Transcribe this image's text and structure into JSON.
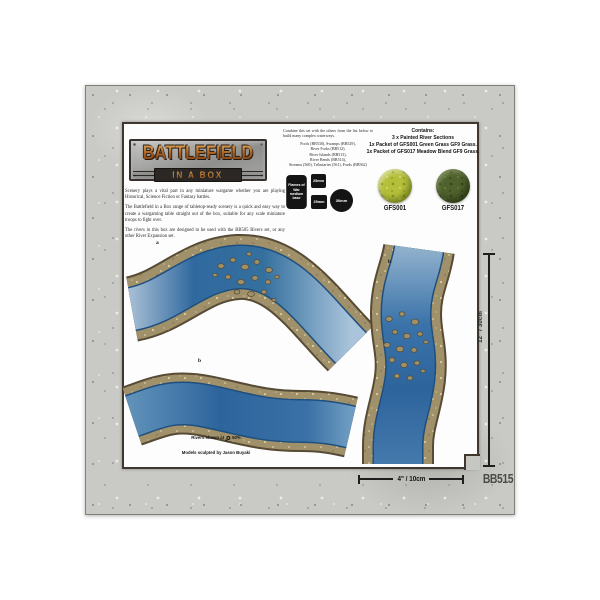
{
  "package": {
    "sku": "BB515",
    "logo": {
      "title": "BATTLEFIELD",
      "subtitle": "IN A BOX"
    },
    "intro_paragraphs": {
      "p1": "Scenery plays a vital part in any miniature wargame whether you are playing Historical, Science Fiction or Fantasy battles.",
      "p2": "The Battlefield in a Box range of tabletop-ready scenery is a quick and easy way to create a wargaming table straight out of the box, suitable for any scale miniature troops to fight over.",
      "p3": "The rivers in this box are designed to be used with the BB505 Rivers set, or any other River Expansion set."
    },
    "combine": {
      "intro": "Combine this set with the others from the list below to build many complex waterways.",
      "list": [
        "Pools (BB530), Swamps (BB529),",
        "River Forks (BB512),",
        "River Islands (BB513),",
        "River Bends (BB514),",
        "Streams (560), Tributaries (561), Fords (BB562)"
      ]
    },
    "contains": {
      "title": "Contains:",
      "lines": [
        "3 x Painted River Sections",
        "1x Packet of GFS001 Green Grass GF9 Grass.",
        "1x Packet of GFS017 Meadow Blend GF9 Grass."
      ]
    },
    "swatches": [
      {
        "code": "GFS001",
        "color": "#b4bf3a"
      },
      {
        "code": "GFS017",
        "color": "#4f612c"
      }
    ],
    "base_sizes": {
      "flames_label": "Flames of War medium base",
      "square_top": "25mm",
      "square_bottom": "25mm",
      "round": "30mm"
    },
    "river_labels": {
      "a": "a",
      "b1": "b",
      "b2": "b"
    },
    "scale_note": {
      "prefix": "Rivers shown at",
      "value": "50%"
    },
    "credit": "Models sculpted by Jason Buyaki",
    "dimensions": {
      "vertical": "12\" / 30cm",
      "horizontal": "4\" / 10cm"
    },
    "colors": {
      "water_deep": "#2d649c",
      "water_light": "#a9c4db",
      "bank_tan": "#a0916a",
      "stone_border": "#c9cac5",
      "frame": "#3f372e"
    }
  }
}
